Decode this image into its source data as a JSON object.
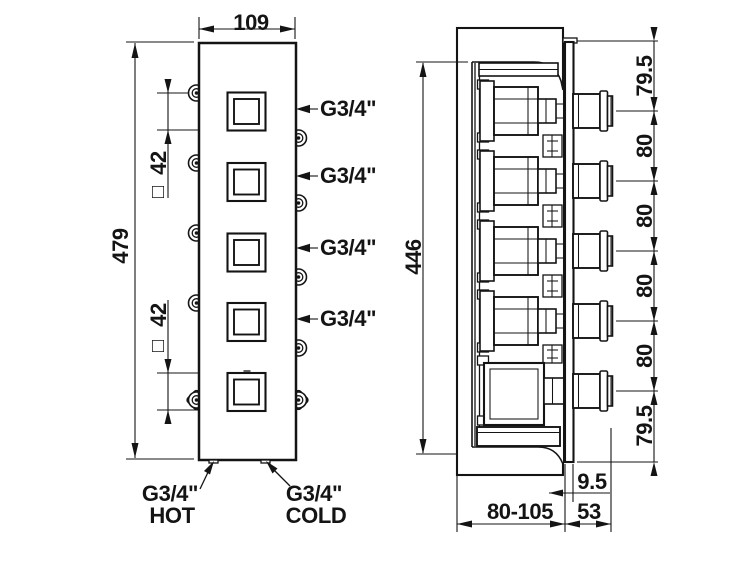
{
  "front_view": {
    "width_dim": "109",
    "height_dim": "479",
    "square_dims": [
      "42",
      "42"
    ],
    "square_symbol": "□",
    "outlet_labels": [
      "G3/4\"",
      "G3/4\"",
      "G3/4\"",
      "G3/4\""
    ],
    "hot": {
      "thread": "G3/4\"",
      "label": "HOT"
    },
    "cold": {
      "thread": "G3/4\"",
      "label": "COLD"
    }
  },
  "side_view": {
    "height_dim": "446",
    "spacing_dims": [
      "79.5",
      "80",
      "80",
      "80",
      "80",
      "79.5"
    ],
    "plate_gap_dim": "9.5",
    "depth_range_dim": "80-105",
    "protrusion_dim": "53"
  }
}
